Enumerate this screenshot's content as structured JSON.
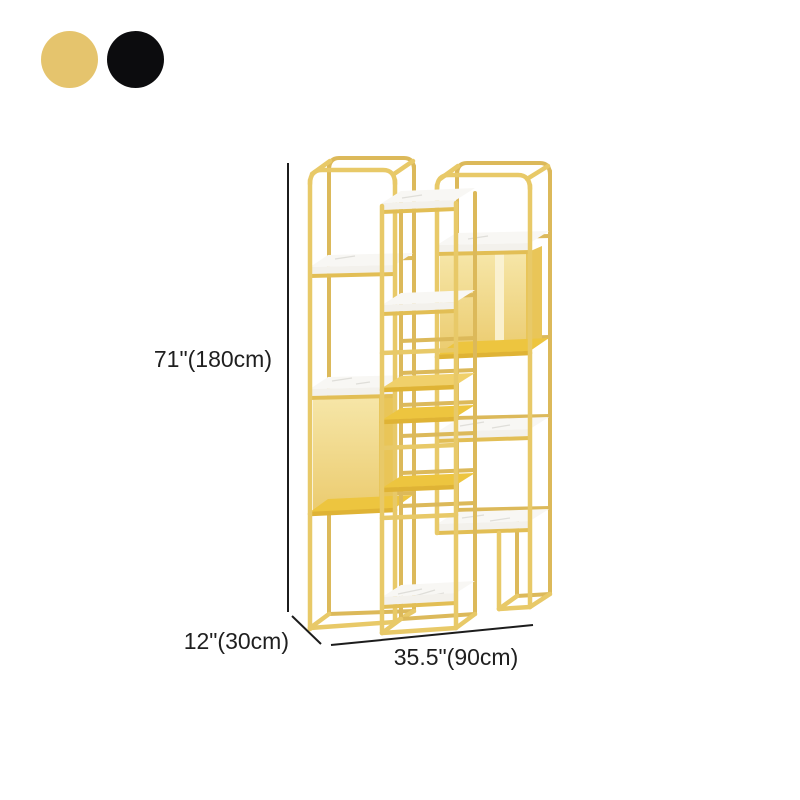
{
  "canvas": {
    "background": "#FFFFFF"
  },
  "swatches": {
    "items": [
      {
        "name": "gold",
        "color": "#E5C46D"
      },
      {
        "name": "black",
        "color": "#0C0C0E"
      }
    ]
  },
  "product": {
    "name": "Gold metal etagere display shelf with marble tiers",
    "colors": {
      "frame_color": "#E8C968",
      "frame_dark": "#DCB95A",
      "panel_light": "#F6E6A8",
      "panel_dark": "#EBCB6E",
      "panel_side": "#E9C558",
      "panel_highlight": "#FBF3D6",
      "gold_shelf_top": "#EDC53F",
      "gold_shelf_light": "#F0D06A",
      "gold_shelf_edge": "#DFB335",
      "marble_top": "#F8F7F4",
      "marble_band": "#F3F1EC",
      "marble_vein": "#D8D7D2",
      "marble_rail": "#E2BE55"
    }
  },
  "dimensions": {
    "height_label": "71\"(180cm)",
    "depth_label": "12\"(30cm)",
    "width_label": "35.5\"(90cm)",
    "line_color": "#1C1C1C",
    "text_color": "#1F1F1F"
  }
}
